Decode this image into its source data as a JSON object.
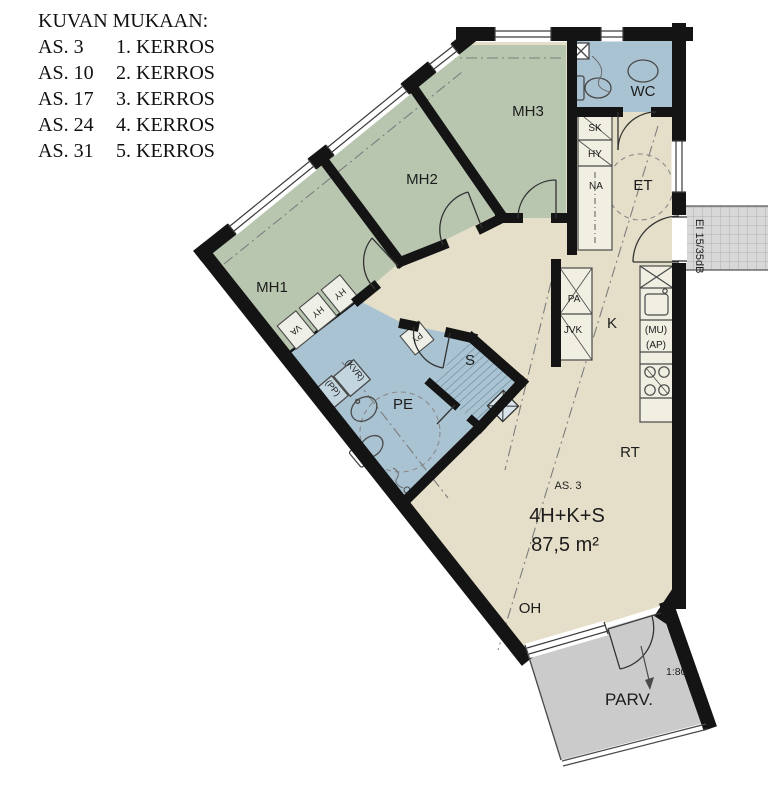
{
  "legend": {
    "title": "KUVAN MUKAAN:",
    "rows": [
      {
        "as": "AS. 3",
        "floor": "1. KERROS"
      },
      {
        "as": "AS. 10",
        "floor": "2. KERROS"
      },
      {
        "as": "AS. 17",
        "floor": "3. KERROS"
      },
      {
        "as": "AS. 24",
        "floor": "4. KERROS"
      },
      {
        "as": "AS. 31",
        "floor": "5. KERROS"
      }
    ]
  },
  "rooms": {
    "mh1": "MH1",
    "mh2": "MH2",
    "mh3": "MH3",
    "wc": "WC",
    "et": "ET",
    "k": "K",
    "pe": "PE",
    "s": "S",
    "rt": "RT",
    "oh": "OH",
    "parv": "PARV."
  },
  "fixtures": {
    "sk": "SK",
    "hy": "HY",
    "na": "NA",
    "pa": "PA",
    "jvk": "JVK",
    "mu": "(MU)",
    "ap": "(AP)",
    "py": "PY",
    "va": "VA",
    "hy2": "HY",
    "hy3": "HY",
    "kvr": "(KVR)",
    "pp": "(PP)"
  },
  "apartment": {
    "number": "AS. 3",
    "layout": "4H+K+S",
    "area": "87,5 m²"
  },
  "annotations": {
    "fire_rating": "EI 15/35dB",
    "scale": "1:80"
  },
  "colors": {
    "bedroom": "#b8c6b0",
    "wet": "#a9c3d2",
    "living": "#e5dfc9",
    "balcony": "#cbcbcb",
    "landing": "#d8d8d8",
    "wall": "#141414"
  }
}
